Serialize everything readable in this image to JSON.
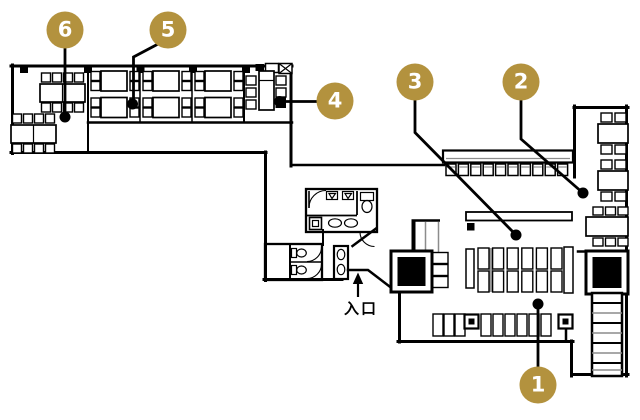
{
  "floorplan": {
    "markers": [
      {
        "num": "1"
      },
      {
        "num": "2"
      },
      {
        "num": "3"
      },
      {
        "num": "4"
      },
      {
        "num": "5"
      },
      {
        "num": "6"
      }
    ],
    "entrance_label": "入口",
    "colors": {
      "marker_fill": "#B3923E",
      "marker_text": "#FFFFFF",
      "wall": "#000000",
      "secondary_line": "#8C8C8C",
      "background": "#FFFFFF"
    }
  }
}
